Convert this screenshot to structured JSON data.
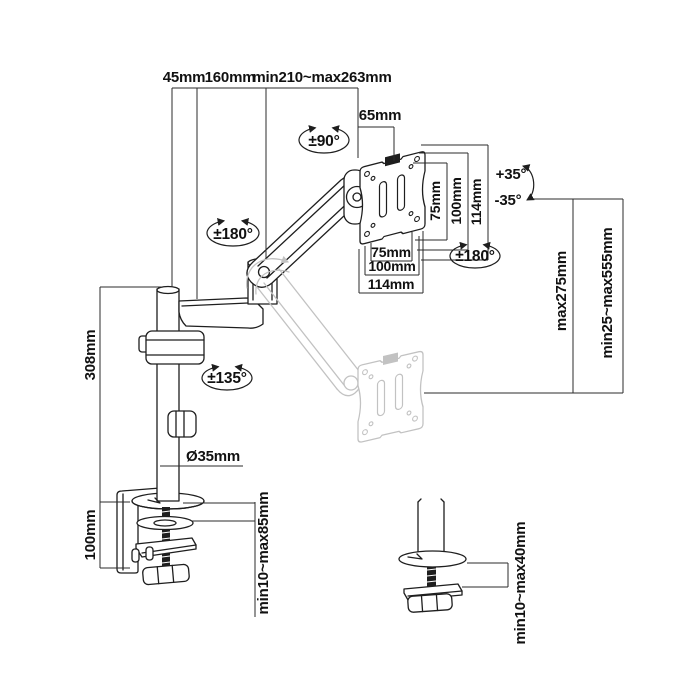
{
  "title": "monitor-arm-dimension-diagram",
  "colors": {
    "ink": "#1e1e1e",
    "ghost": "#c2c2c2",
    "dim_line": "#2b2b2b",
    "text": "#111111",
    "background": "#ffffff"
  },
  "dims": {
    "top": {
      "arm_offset": "45mm",
      "lower_arm_reach": "160mm",
      "upper_arm_reach": "min210~max263mm",
      "head_offset": "65mm"
    },
    "vesa": {
      "v75": "75mm",
      "v100": "100mm",
      "v114": "114mm",
      "h75": "75mm",
      "h100": "100mm",
      "h114": "114mm"
    },
    "pole": {
      "height": "308mm",
      "diameter": "Ø35mm"
    },
    "clamp": {
      "bracket_height": "100mm",
      "desk_thickness_range": "min10~max85mm"
    },
    "right": {
      "vertical_travel": "max275mm",
      "height_range": "min25~max555mm"
    },
    "grommet": {
      "desk_thickness_range": "min10~max40mm"
    }
  },
  "rotations": {
    "head_swivel": "±90°",
    "arm_rotation": "±180°",
    "vesa_rotation": "±180°",
    "pole_swivel": "±135°",
    "tilt_up": "+35°",
    "tilt_down": "-35°"
  }
}
